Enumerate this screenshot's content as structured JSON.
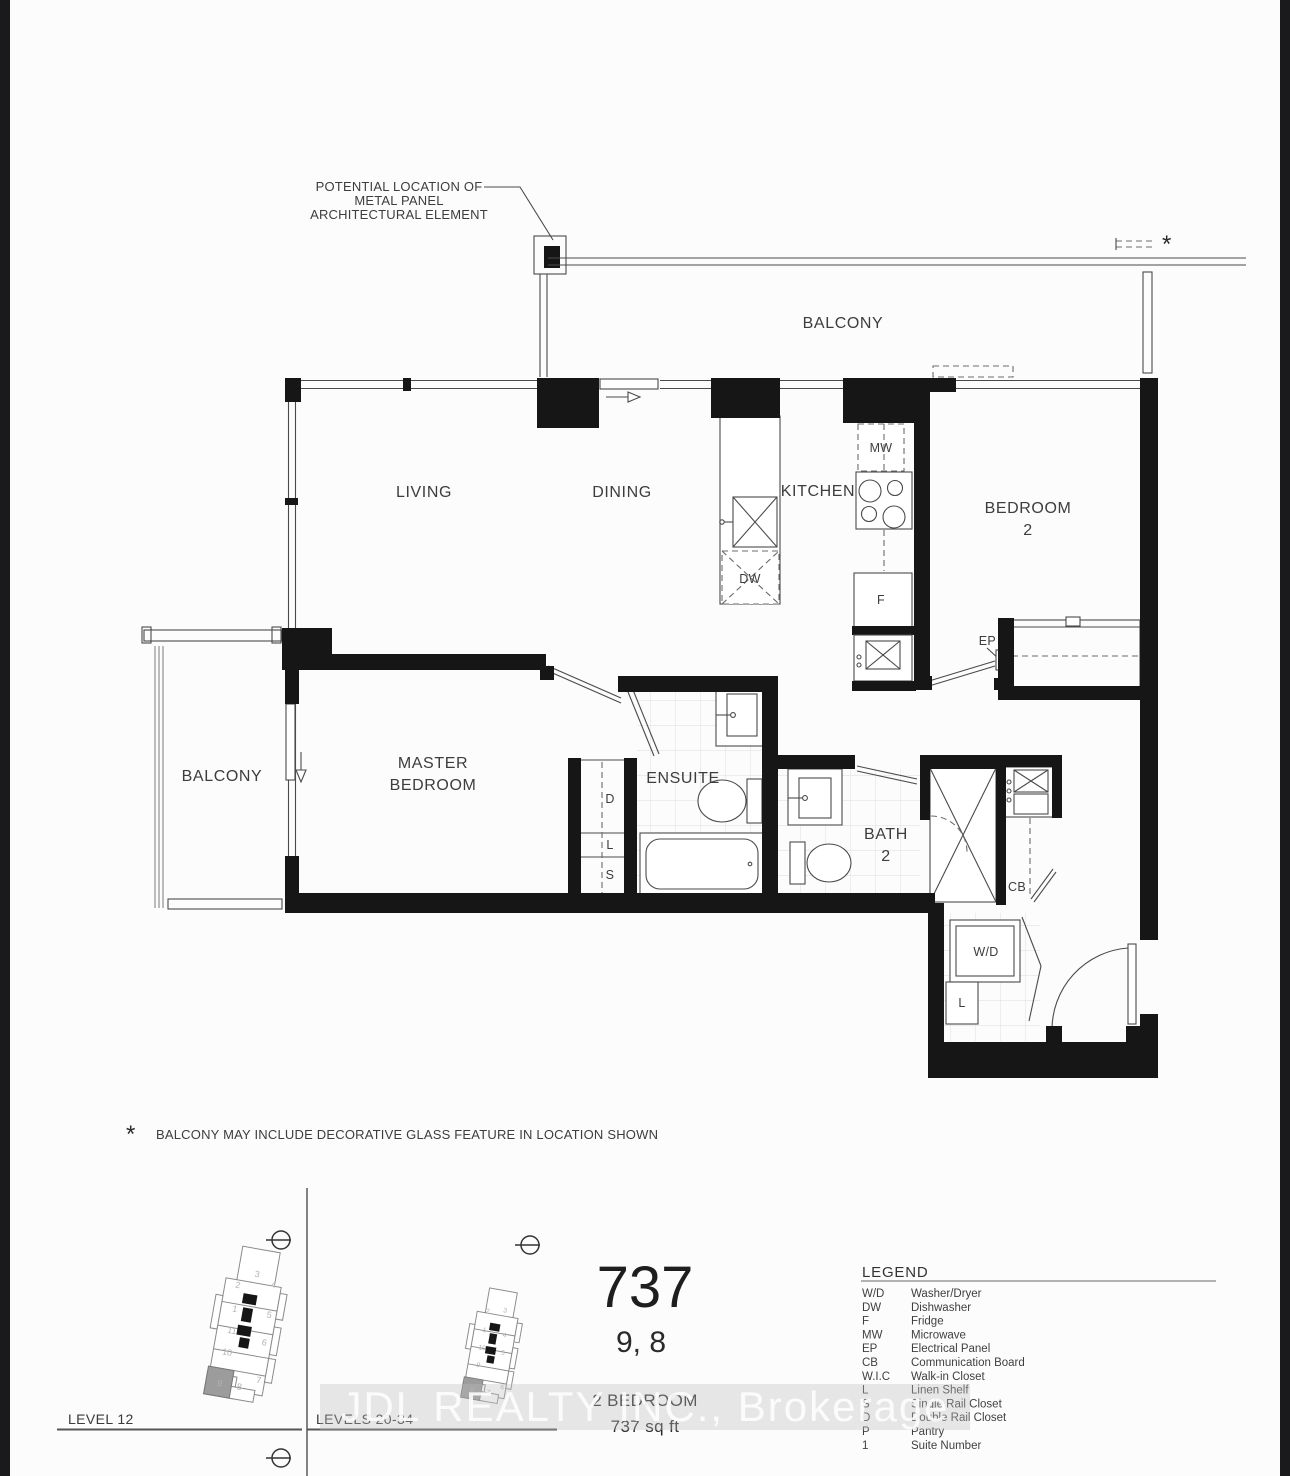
{
  "plan": {
    "annotation": {
      "l1": "POTENTIAL LOCATION OF",
      "l2": "METAL PANEL",
      "l3": "ARCHITECTURAL ELEMENT"
    },
    "glass_marker": "*",
    "rooms": {
      "balcony_top": "BALCONY",
      "living": "LIVING",
      "dining": "DINING",
      "kitchen": "KITCHEN",
      "bedroom2_l1": "BEDROOM",
      "bedroom2_l2": "2",
      "master_l1": "MASTER",
      "master_l2": "BEDROOM",
      "balcony_left": "BALCONY",
      "ensuite": "ENSUITE",
      "bath2_l1": "BATH",
      "bath2_l2": "2"
    },
    "codes": {
      "mw": "MW",
      "fridge": "F",
      "dw": "DW",
      "ep": "EP",
      "cb": "CB",
      "wd": "W/D",
      "closet_d": "D",
      "closet_l": "L",
      "closet_s": "S",
      "wd_linen": "L"
    }
  },
  "footnote": {
    "marker": "*",
    "text": "BALCONY MAY INCLUDE DECORATIVE GLASS FEATURE IN LOCATION SHOWN"
  },
  "unit": {
    "number": "737",
    "suites": "9, 8",
    "type": "2 BEDROOM",
    "area": "737 sq ft"
  },
  "keyplans": [
    {
      "label": "LEVEL 12",
      "highlighted_unit": "9",
      "units": [
        "3",
        "4",
        "2",
        "1",
        "5",
        "11",
        "10",
        "6",
        "9",
        "8",
        "7"
      ]
    },
    {
      "label": "LEVELS 20-34",
      "highlighted_unit": "8",
      "units": [
        "2",
        "3",
        "1",
        "4",
        "10",
        "5",
        "9",
        "8",
        "7",
        "6"
      ]
    }
  ],
  "legend": {
    "title": "LEGEND",
    "entries": [
      {
        "abbr": "W/D",
        "desc": "Washer/Dryer"
      },
      {
        "abbr": "DW",
        "desc": "Dishwasher"
      },
      {
        "abbr": "F",
        "desc": "Fridge"
      },
      {
        "abbr": "MW",
        "desc": "Microwave"
      },
      {
        "abbr": "EP",
        "desc": "Electrical Panel"
      },
      {
        "abbr": "CB",
        "desc": "Communication Board"
      },
      {
        "abbr": "W.I.C",
        "desc": "Walk-in Closet"
      },
      {
        "abbr": "L",
        "desc": "Linen Shelf"
      },
      {
        "abbr": "S",
        "desc": "Single Rail Closet"
      },
      {
        "abbr": "D",
        "desc": "Double Rail Closet"
      },
      {
        "abbr": "P",
        "desc": "Pantry"
      },
      {
        "abbr": "1",
        "desc": "Suite Number"
      }
    ]
  },
  "watermark": {
    "text": "JDL REALTY INC., Brokerage"
  }
}
